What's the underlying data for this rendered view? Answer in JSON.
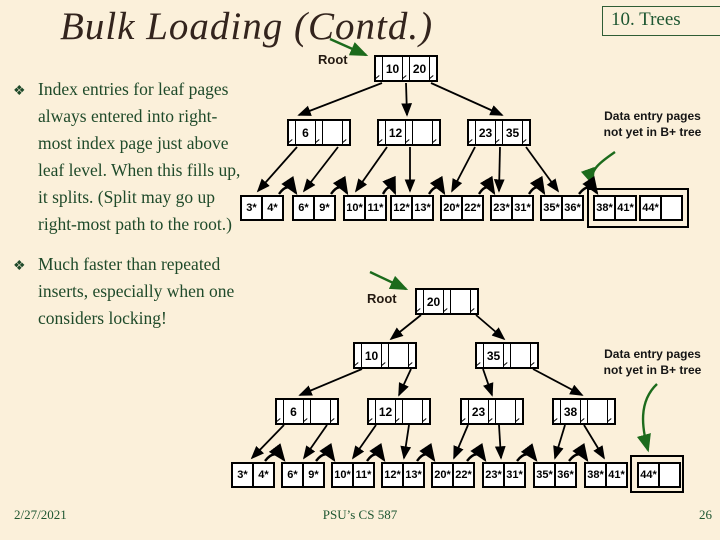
{
  "slide": {
    "title": "Bulk Loading (Contd.)",
    "corner_tag": "10. Trees",
    "bullet_glyph": "❖",
    "bullets": [
      "Index entries for leaf pages always entered into right-most index page just above leaf level.  When this fills up, it splits.  (Split may go up right-most path to the root.)",
      "Much faster than repeated inserts, especially when one considers locking!"
    ],
    "footer": {
      "date": "2/27/2021",
      "course": "PSU’s CS 587",
      "page": "26"
    }
  },
  "colors": {
    "background": "#FBF0DA",
    "body_text_green": "#1F4A2A",
    "corner_green": "#1E5631",
    "title_color": "#33241D",
    "annotation_arrow_green": "#1C6B1C",
    "node_fill": "#FFFFFF",
    "node_border": "#000000"
  },
  "tree_before": {
    "root_label": "Root",
    "note_line1": "Data entry pages",
    "note_line2": "not yet in B+ tree",
    "root_keys": [
      "10",
      "20"
    ],
    "level2": [
      {
        "keys": [
          "6",
          ""
        ]
      },
      {
        "keys": [
          "12",
          ""
        ]
      },
      {
        "keys": [
          "23",
          "35"
        ]
      }
    ],
    "leaves": [
      [
        "3*",
        "4*"
      ],
      [
        "6*",
        "9*"
      ],
      [
        "10*",
        "11*"
      ],
      [
        "12*",
        "13*"
      ],
      [
        "20*",
        "22*"
      ],
      [
        "23*",
        "31*"
      ],
      [
        "35*",
        "36*"
      ]
    ],
    "pending_leaves": [
      [
        "38*",
        "41*"
      ],
      [
        "44*",
        ""
      ]
    ]
  },
  "tree_after": {
    "root_label": "Root",
    "note_line1": "Data entry pages",
    "note_line2": "not yet in B+ tree",
    "root_keys": [
      "20",
      ""
    ],
    "level2": [
      {
        "keys": [
          "10",
          ""
        ]
      },
      {
        "keys": [
          "35",
          ""
        ]
      }
    ],
    "level3": [
      {
        "keys": [
          "6",
          ""
        ]
      },
      {
        "keys": [
          "12",
          ""
        ]
      },
      {
        "keys": [
          "23",
          ""
        ]
      },
      {
        "keys": [
          "38",
          ""
        ]
      }
    ],
    "leaves": [
      [
        "3*",
        "4*"
      ],
      [
        "6*",
        "9*"
      ],
      [
        "10*",
        "11*"
      ],
      [
        "12*",
        "13*"
      ],
      [
        "20*",
        "22*"
      ],
      [
        "23*",
        "31*"
      ],
      [
        "35*",
        "36*"
      ],
      [
        "38*",
        "41*"
      ]
    ],
    "pending_leaves": [
      [
        "44*",
        ""
      ]
    ]
  }
}
